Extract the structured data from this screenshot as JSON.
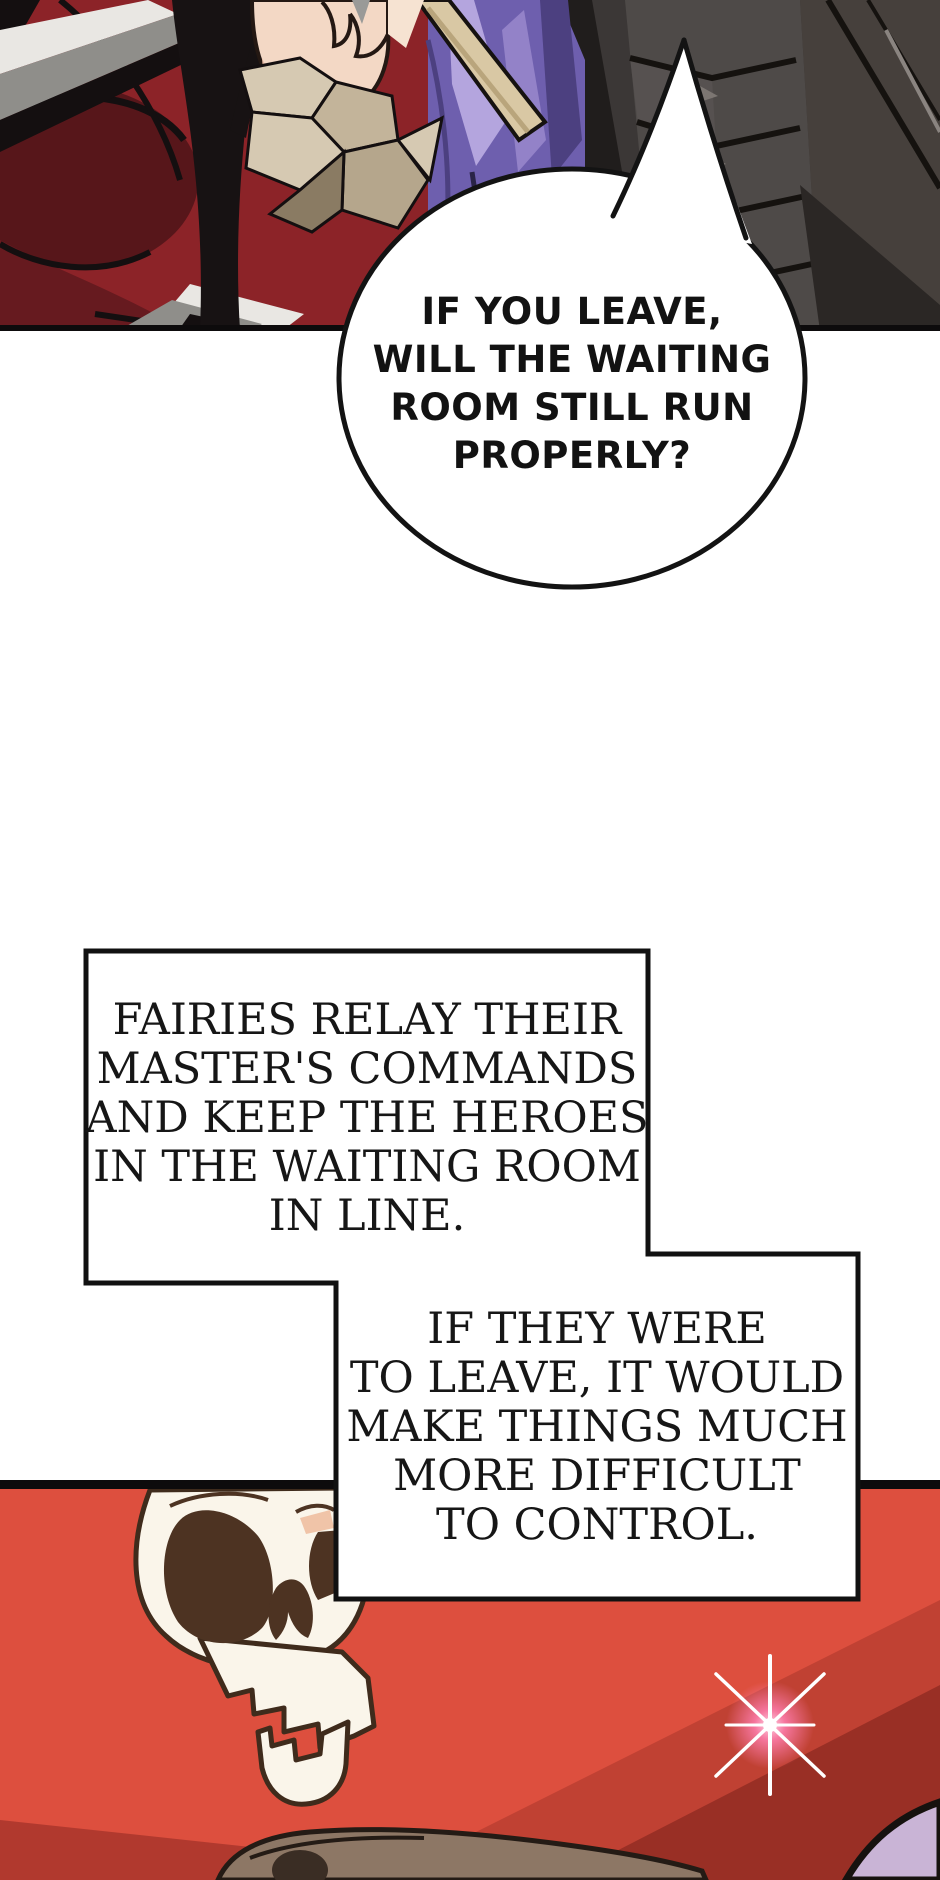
{
  "page_type": "webtoon comic panel",
  "speech_bubble": {
    "shape": "white ellipse with tail pointing up-right to armored figure",
    "lines": [
      "IF YOU LEAVE,",
      "WILL THE WAITING",
      "ROOM STILL RUN",
      "PROPERLY?"
    ]
  },
  "narration_boxes": [
    {
      "lines": [
        "FAIRIES RELAY THEIR",
        "MASTER'S COMMANDS",
        "AND KEEP THE HEROES",
        "IN THE WAITING ROOM",
        "IN LINE."
      ]
    },
    {
      "lines": [
        "IF THEY WERE",
        "TO LEAVE, IT WOULD",
        "MAKE THINGS MUCH",
        "MORE DIFFICULT",
        "TO CONTROL."
      ]
    }
  ],
  "artwork": {
    "top_panel": {
      "elements": [
        "red-sleeved-figure",
        "black-hair-strands",
        "clenched-hand",
        "ruffled-cuff",
        "beige-staff",
        "purple-cloth",
        "segmented-dark-armor"
      ],
      "colors": {
        "red": "#8c2328",
        "dark_red": "#57161a",
        "skin": "#f3d8c5",
        "ruffle": "#d6c9b2",
        "staff": "#d9c8a4",
        "purple": "#6e5fae",
        "armor": "#3b3736"
      }
    },
    "bottom_panel": {
      "elements": [
        "cartoon-skull",
        "detached-jaw",
        "pink-sparkle",
        "bone-band",
        "lavender-corner"
      ],
      "colors": {
        "background_red": "#dd4f3e",
        "shadow_red": "#8e2a22",
        "skull": "#faf5ea",
        "socket_brown": "#4d3322",
        "sparkle_pink": "#ff7fb0",
        "lavender": "#c9b4d6"
      }
    }
  }
}
